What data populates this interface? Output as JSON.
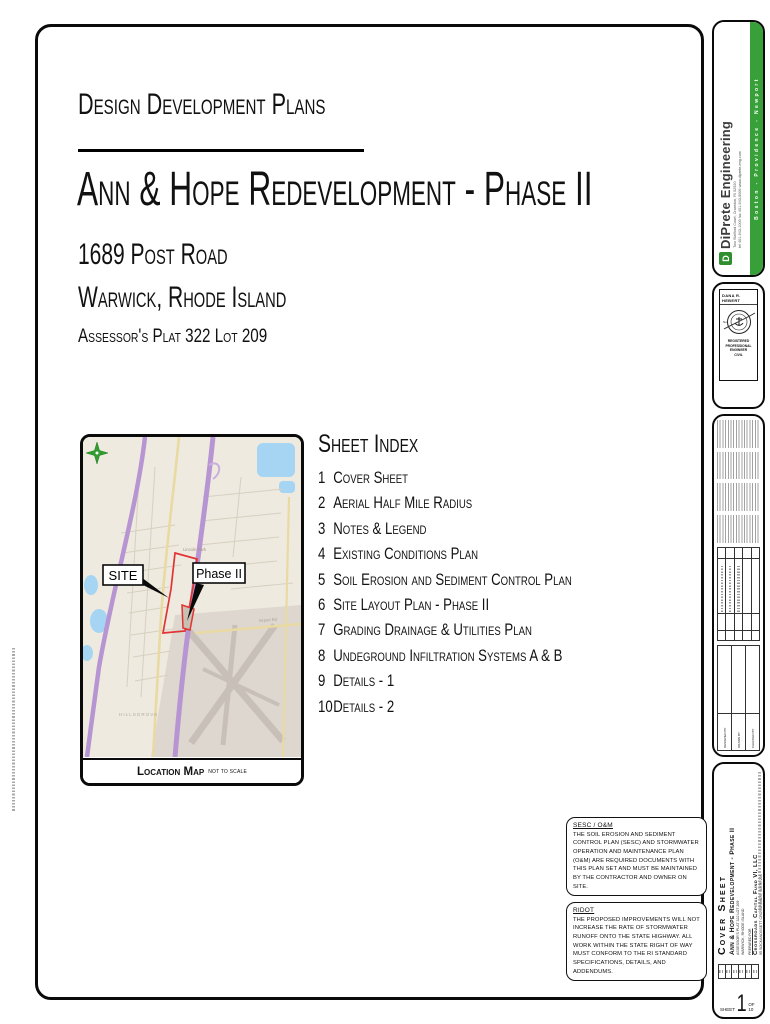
{
  "header": {
    "plan_type": "Design Development Plans",
    "project_title": "Ann & Hope Redevelopment - Phase II",
    "address": "1689 Post Road",
    "city_state": "Warwick, Rhode Island",
    "assessor": "Assessor's Plat 322 Lot 209"
  },
  "sheet_index": {
    "title": "Sheet Index",
    "items": [
      {
        "num": "1",
        "name": "Cover Sheet"
      },
      {
        "num": "2",
        "name": "Aerial Half Mile Radius"
      },
      {
        "num": "3",
        "name": "Notes & Legend"
      },
      {
        "num": "4",
        "name": "Existing Conditions Plan"
      },
      {
        "num": "5",
        "name": "Soil Erosion and Sediment Control Plan"
      },
      {
        "num": "6",
        "name": "Site Layout Plan - Phase II"
      },
      {
        "num": "7",
        "name": "Grading Drainage & Utilities Plan"
      },
      {
        "num": "8",
        "name": "Undeground Infiltration Systems A & B"
      },
      {
        "num": "9",
        "name": "Details - 1"
      },
      {
        "num": "10",
        "name": "Details - 2"
      }
    ]
  },
  "location_map": {
    "caption": "Location Map",
    "scale_note": "NOT TO SCALE",
    "site_callout": "SITE",
    "phase_callout": "Phase II",
    "label_park": "Lincoln Park",
    "label_district": "HILLSGROVE",
    "label_road": "Airport Rd"
  },
  "notes": {
    "sesc_title": "SESC / O&M",
    "sesc_body": "THE SOIL EROSION AND SEDIMENT CONTROL PLAN (SESC) AND STORMWATER OPERATION AND MAINTENANCE PLAN (O&M) ARE REQUIRED DOCUMENTS WITH THIS PLAN SET AND MUST BE MAINTAINED BY THE CONTRACTOR AND OWNER ON SITE.",
    "ridot_title": "RIDOT",
    "ridot_body": "THE PROPOSED IMPROVEMENTS WILL NOT INCREASE THE RATE OF STORMWATER RUNOFF ONTO THE STATE HIGHWAY. ALL WORK WITHIN THE STATE RIGHT OF WAY MUST CONFORM TO THE RI STANDARD SPECIFICATIONS, DETAILS, AND ADDENDUMS."
  },
  "firm": {
    "name": "DiPrete Engineering",
    "logo_letter": "D",
    "address_line1": "Two Stafford Court, Cranston, RI 02920",
    "address_line2": "tel 401-943-1000  fax 401-943-6006  www.diprete-eng.com",
    "offices": "Boston - Providence - Newport",
    "brand_green": "#38a038"
  },
  "stamp": {
    "name": "DANA R. HEBERT",
    "no_label": "No.",
    "registered": "REGISTERED",
    "profession": "PROFESSIONAL ENGINEER",
    "discipline": "CIVIL"
  },
  "revisions": {
    "designed_by": "DESIGNED BY",
    "drawn_by": "DRAWN BY",
    "checked_by": "CHECKED BY"
  },
  "title_strip": {
    "sheet_title": "Cover Sheet",
    "project": "Ann & Hope Redevelopment - Phase II",
    "assessor": "ASSESSOR'S PLAT 322 LOT 209",
    "city": "WARWICK, RHODE ISLAND",
    "prepared_for": "PREPARED FOR",
    "client": "Crossroads Capital Fund VI, LLC",
    "client_address": "95 SOCKANOSSETT CROSSROADS, SUITE 203",
    "client_city": "CRANSTON, RI 02920"
  },
  "sheet_label": {
    "label": "SHEET",
    "number": "1",
    "of": "OF 10"
  }
}
